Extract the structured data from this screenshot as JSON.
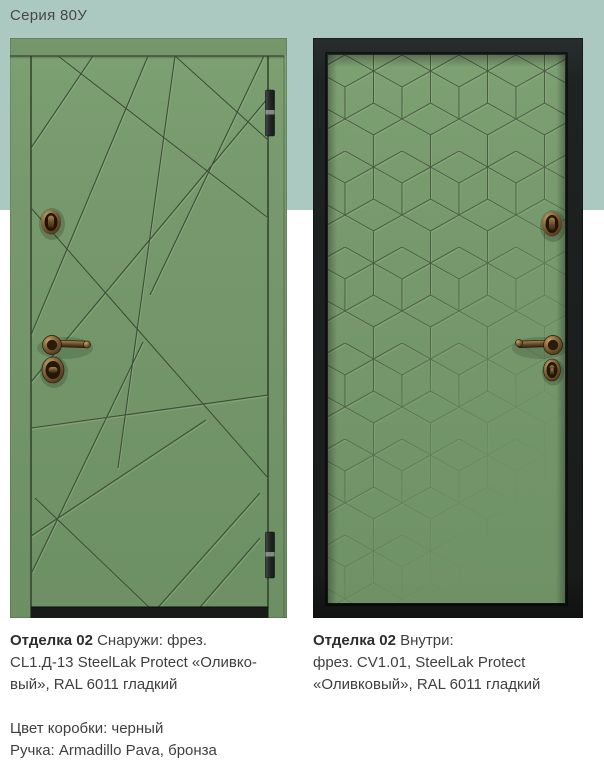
{
  "title": "Серия 80У",
  "captions": {
    "left": {
      "bold": "Отделка 02",
      "rest": " Снаружи: фрез.\nCL1.Д-13 SteelLak Protect «Оливко-\nвый», RAL 6011 гладкий",
      "details": "Цвет коробки: черный\nРучка: Armadillo Pava, бронза"
    },
    "right": {
      "bold": "Отделка 02",
      "rest": " Внутри:\nфрез. CV1.01, SteelLak Protect\n«Оливковый», RAL 6011 гладкий"
    }
  },
  "colors": {
    "background": "#ffffff",
    "band": "#abc9c1",
    "door_green": "#74956b",
    "groove": "#3c4f36",
    "frame_black": "#1d1f1e",
    "hardware_bronze": "#6e5230",
    "text": "#3f3f3f",
    "title": "#474747"
  }
}
